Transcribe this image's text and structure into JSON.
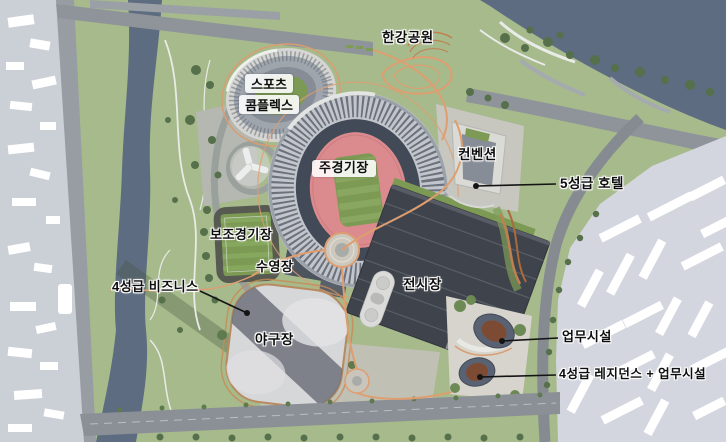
{
  "labels": {
    "hangang_park": "한강공원",
    "sports_complex_l1": "스포츠",
    "sports_complex_l2": "콤플렉스",
    "main_stadium": "주경기장",
    "convention": "컨벤션",
    "hotel_5star": "5성급 호텔",
    "auxiliary_stadium": "보조경기장",
    "swimming_pool": "수영장",
    "business_4star": "4성급 비즈니스",
    "exhibition_hall": "전시장",
    "baseball_stadium": "야구장",
    "office_facility": "업무시설",
    "residence_4star": "4성급 레지던스 + 업무시설"
  },
  "colors": {
    "park_green": "#a6ba8c",
    "river_water": "#5d6c80",
    "road_gray": "#8f949a",
    "city_left_bg": "#cbcfd6",
    "city_right_bg": "#d4d6df",
    "stadium_rim": "#c2c6cc",
    "stadium_bowl": "#434a57",
    "track_pink": "#db8b8e",
    "field_green": "#7d9a55",
    "exhibition_roof": "#3f434b",
    "path_orange": "#df9e6f",
    "tower_roof_brown": "#7d4b34",
    "leader_line": "#141414",
    "label_text": "#0e0e0e"
  }
}
